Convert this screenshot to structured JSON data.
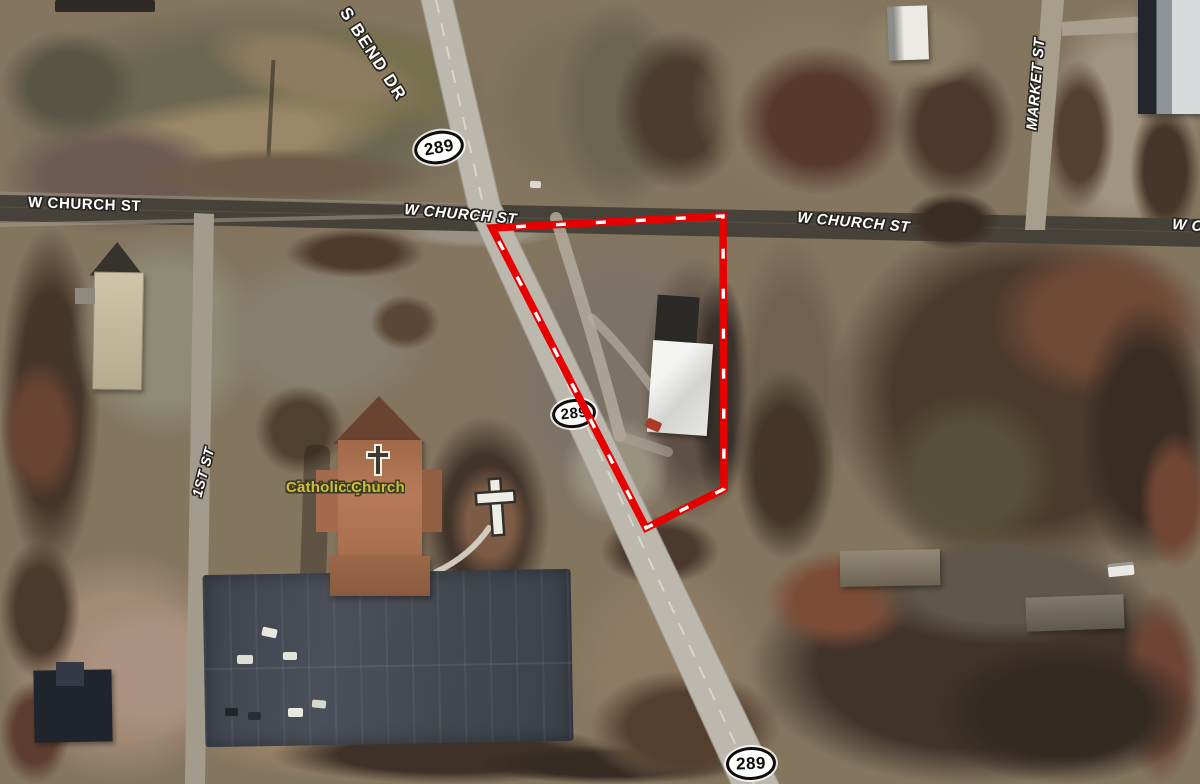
{
  "map": {
    "street_labels": {
      "w_church_left": "W CHURCH ST",
      "w_church_center": "W CHURCH ST",
      "w_church_right": "W CHURCH ST",
      "w_church_edge": "W CHURCH ST",
      "s_bend": "S BEND DR",
      "market": "MARKET ST",
      "first": "1ST ST"
    },
    "highway_shields": [
      {
        "route": "289"
      },
      {
        "route": "289"
      },
      {
        "route": "289"
      }
    ],
    "poi_label": {
      "line1": "Saint Mary",
      "line2": "of the Mount",
      "line3": "Catholic Church",
      "color": "#cdc13a",
      "icon": "latin-cross"
    },
    "boundary": {
      "color": "#e60000",
      "dash_color": "#ffffff",
      "vertices": [
        [
          492,
          228
        ],
        [
          723,
          216
        ],
        [
          724,
          489
        ],
        [
          646,
          528
        ]
      ]
    },
    "label_colors": {
      "street_text": "#ffffff",
      "street_outline": "#26231f",
      "shield_text": "#0d0d0d",
      "shield_bg": "#fdfdfa"
    }
  }
}
